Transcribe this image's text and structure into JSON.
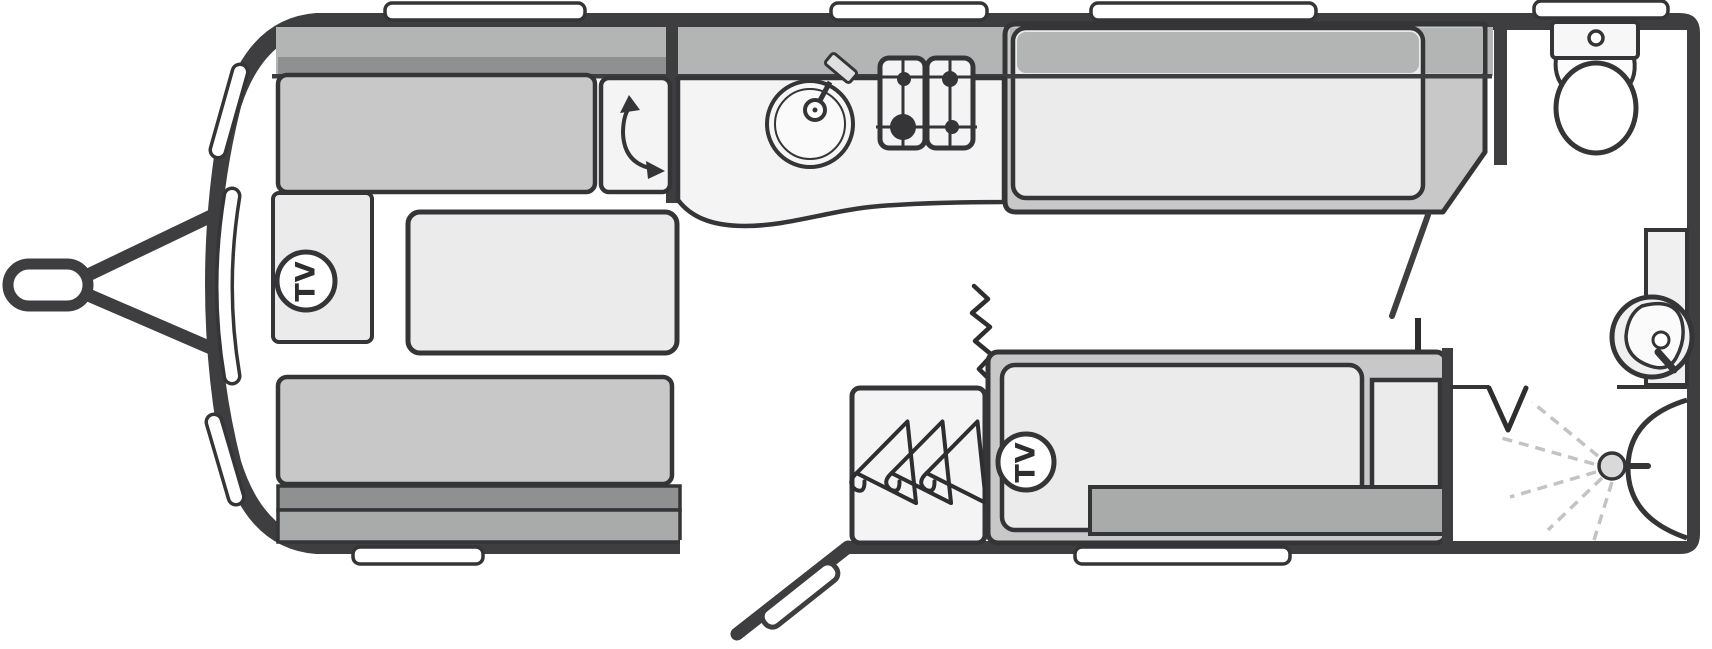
{
  "diagram": {
    "type": "caravan-floorplan",
    "labels": {
      "front_tv": "TV",
      "bedroom_tv": "TV"
    },
    "colors": {
      "wall": "#3e3e40",
      "outline": "#353537",
      "upholstery": "#c7c8c7",
      "shelf_band": "#b3b5b4",
      "shelf_band_dark": "#8f9190",
      "base_band": "#a9abaa",
      "mattress": "#ebebeb",
      "worktop": "#f4f4f4",
      "floor": "#ffffff"
    },
    "areas": [
      {
        "name": "front-lounge",
        "items": [
          "sofa-top",
          "sofa-bottom",
          "table",
          "tv-cabinet",
          "locker-with-door-swing"
        ]
      },
      {
        "name": "kitchen",
        "items": [
          "sink-with-tap",
          "two-panel-hob",
          "curved-worktop"
        ]
      },
      {
        "name": "bedroom",
        "items": [
          "single-bed-offside",
          "single-bed-nearside",
          "wardrobe-with-hangers",
          "tv-point",
          "concertina-divider"
        ]
      },
      {
        "name": "washroom",
        "items": [
          "toilet",
          "basin-vanity",
          "shower-with-spray",
          "bifold-door-mark"
        ]
      }
    ],
    "exterior": [
      "tow-hitch",
      "a-frame",
      "six-wall-windows",
      "three-front-windows",
      "entrance-door-open"
    ]
  }
}
